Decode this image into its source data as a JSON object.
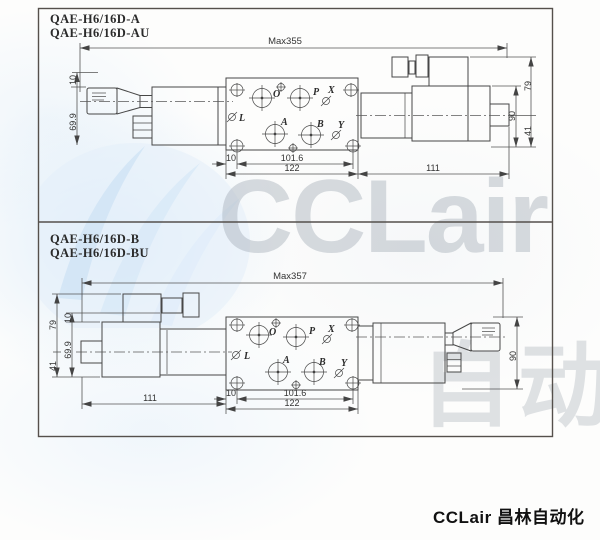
{
  "page": {
    "footer_brand": "CCLair 昌林自动化",
    "watermark_brand": "CCLair",
    "watermark_cn": "自动化"
  },
  "drawing_a": {
    "model_line1": "QAE-H6/16D-A",
    "model_line2": "QAE-H6/16D-AU",
    "overall_length": "Max355",
    "dims": {
      "knob_offset": "10",
      "knob_height": "69.9",
      "solenoid_top": "79",
      "solenoid_height": "90",
      "solenoid_bottom": "41",
      "bolt_offset": "10",
      "bolt_spacing": "101.6",
      "block_length": "122",
      "solenoid_length": "111"
    },
    "ports": {
      "o": "O",
      "p": "P",
      "x": "X",
      "l": "L",
      "a": "A",
      "b": "B",
      "y": "Y"
    }
  },
  "drawing_b": {
    "model_line1": "QAE-H6/16D-B",
    "model_line2": "QAE-H6/16D-BU",
    "overall_length": "Max357",
    "dims": {
      "solenoid_top": "79",
      "knob_offset": "10",
      "knob_height": "69.9",
      "solenoid_bottom": "41",
      "solenoid_length": "111",
      "bolt_offset": "10",
      "bolt_spacing": "101.6",
      "block_length": "122",
      "valve_height": "90"
    },
    "ports": {
      "o": "O",
      "p": "P",
      "x": "X",
      "l": "L",
      "a": "A",
      "b": "B",
      "y": "Y"
    }
  }
}
